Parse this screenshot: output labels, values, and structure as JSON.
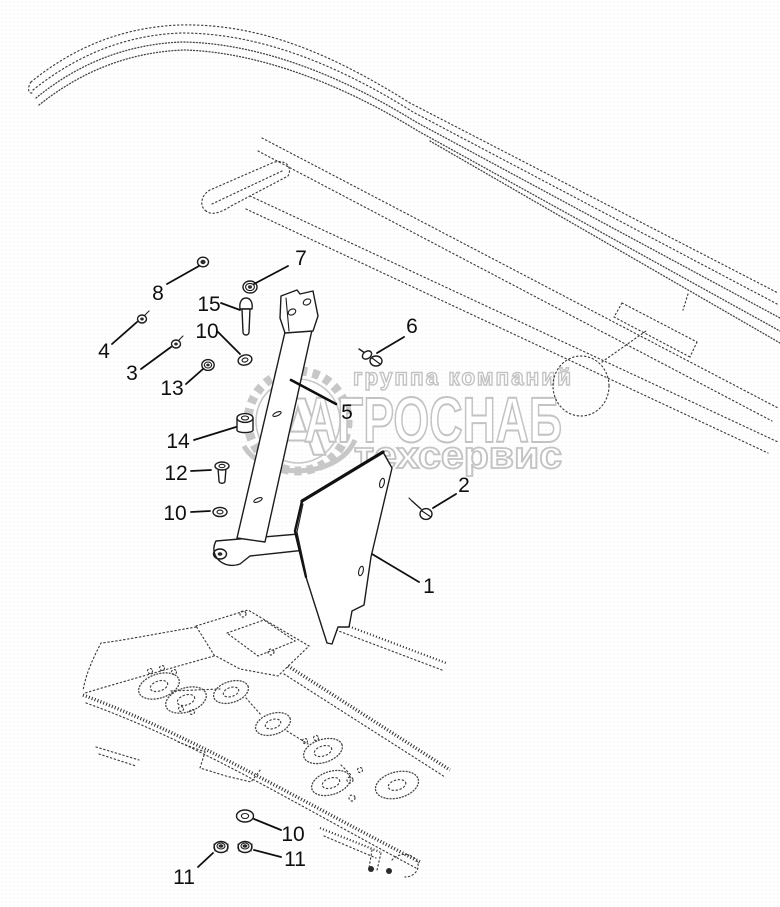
{
  "diagram": {
    "background": "#ffffff",
    "ink": "#1c1c1c",
    "dotted_ink": "#3d3d3d"
  },
  "watermark": {
    "line1": "группа компаний",
    "line2": "АГРОСНАБ",
    "line3": "техсервис",
    "logo_letter": "А",
    "color": "#c3c3c3"
  },
  "callouts": {
    "c1": {
      "label": "1"
    },
    "c2": {
      "label": "2"
    },
    "c3": {
      "label": "3"
    },
    "c4": {
      "label": "4"
    },
    "c5": {
      "label": "5"
    },
    "c6": {
      "label": "6"
    },
    "c7": {
      "label": "7"
    },
    "c8": {
      "label": "8"
    },
    "c10a": {
      "label": "10"
    },
    "c10b": {
      "label": "10"
    },
    "c10c": {
      "label": "10"
    },
    "c11a": {
      "label": "11"
    },
    "c11b": {
      "label": "11"
    },
    "c12": {
      "label": "12"
    },
    "c13": {
      "label": "13"
    },
    "c14": {
      "label": "14"
    },
    "c15": {
      "label": "15"
    }
  }
}
